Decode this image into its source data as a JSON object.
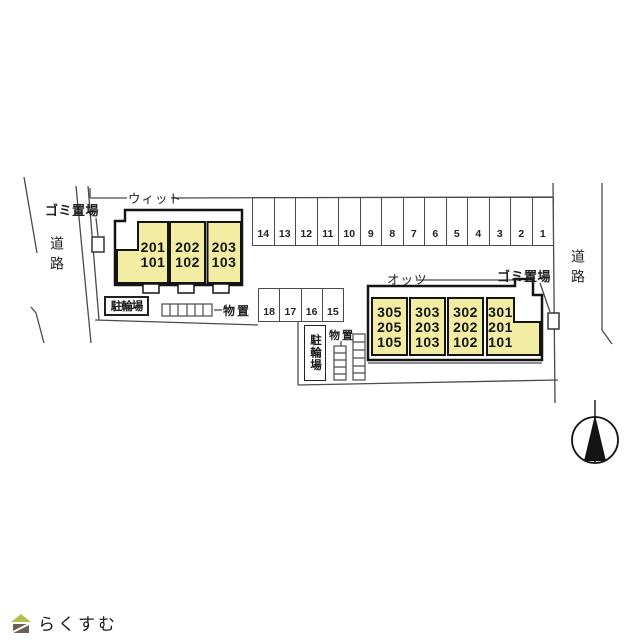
{
  "site_plan": {
    "buildings": {
      "left": {
        "name": "ウィット",
        "units": [
          "201\n101",
          "202\n102",
          "203\n103"
        ]
      },
      "right": {
        "name": "オッツ",
        "units": [
          "305\n205\n105",
          "303\n203\n103",
          "302\n202\n102",
          "301\n201\n101"
        ]
      }
    },
    "parking": {
      "top_row": [
        "14",
        "13",
        "12",
        "11",
        "10",
        "9",
        "8",
        "7",
        "6",
        "5",
        "4",
        "3",
        "2",
        "1"
      ],
      "mid_row": [
        "18",
        "17",
        "16",
        "15"
      ]
    },
    "labels": {
      "garbage_left": "ゴミ置場",
      "garbage_right": "ゴミ置場",
      "road_left": "道路",
      "road_right": "道路",
      "bicycle_left": "駐輪場",
      "bicycle_right": "駐輪場",
      "storage_left": "物置",
      "storage_right": "物置"
    },
    "colors": {
      "building_fill": "#f2eda2",
      "outline": "#141414",
      "boundary_line": "#4a4a4a"
    }
  },
  "branding": {
    "logo_text": "らくすむ",
    "roof_color": "#b5bf4f",
    "body_color": "#6f6057",
    "text_color": "#8d8076"
  }
}
